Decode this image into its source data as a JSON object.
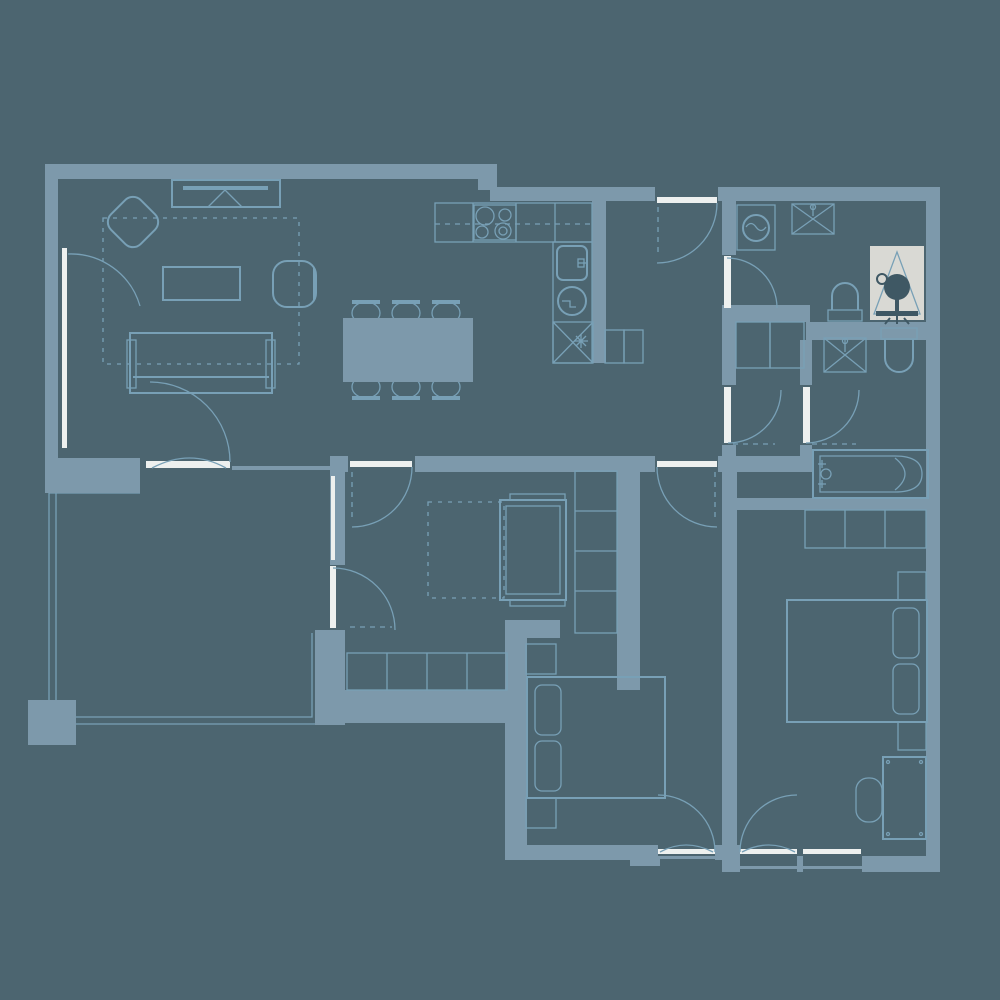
{
  "title": "apartment-floor-plan",
  "colors": {
    "background": "#4c6570",
    "wall": "#7d99ab",
    "line": "#78a0b6",
    "white": "#edf0ef",
    "highlight": "#d9d9d4",
    "dark": "#3f5864"
  },
  "selected_item": {
    "name": "shower-fixture",
    "state": "highlighted",
    "room": "wc-laundry"
  },
  "rooms": [
    {
      "name": "living-room",
      "fixtures": [
        "tv-unit",
        "accent-chair",
        "rug",
        "coffee-table",
        "armchair",
        "sofa",
        "balcony-window",
        "terrace-door"
      ]
    },
    {
      "name": "kitchen-dining",
      "fixtures": [
        "counter",
        "cooktop",
        "kitchen-sink",
        "dishwasher",
        "refrigerator",
        "dining-table",
        "dining-chairs-x6",
        "upper-cabinets"
      ]
    },
    {
      "name": "hallway",
      "fixtures": [
        "entrance-door",
        "closet"
      ]
    },
    {
      "name": "wc-laundry",
      "fixtures": [
        "washing-machine",
        "utility-sink",
        "toilet",
        "shower-fixture"
      ]
    },
    {
      "name": "bathroom-lobby",
      "fixtures": [
        "closet"
      ]
    },
    {
      "name": "bathroom",
      "fixtures": [
        "washbasin",
        "toilet",
        "bathtub"
      ]
    },
    {
      "name": "bedroom-1",
      "fixtures": [
        "single-bed",
        "rug",
        "wardrobe-corner",
        "terrace-door"
      ]
    },
    {
      "name": "bedroom-2",
      "fixtures": [
        "double-bed",
        "nightstand",
        "nightstand",
        "balcony-door"
      ]
    },
    {
      "name": "bedroom-3",
      "fixtures": [
        "double-bed",
        "nightstand",
        "nightstand",
        "wardrobe",
        "desk",
        "desk-chair",
        "balcony-door",
        "window"
      ]
    },
    {
      "name": "terrace",
      "fixtures": [
        "pier"
      ]
    }
  ],
  "door_count": 10,
  "window_count": 5
}
